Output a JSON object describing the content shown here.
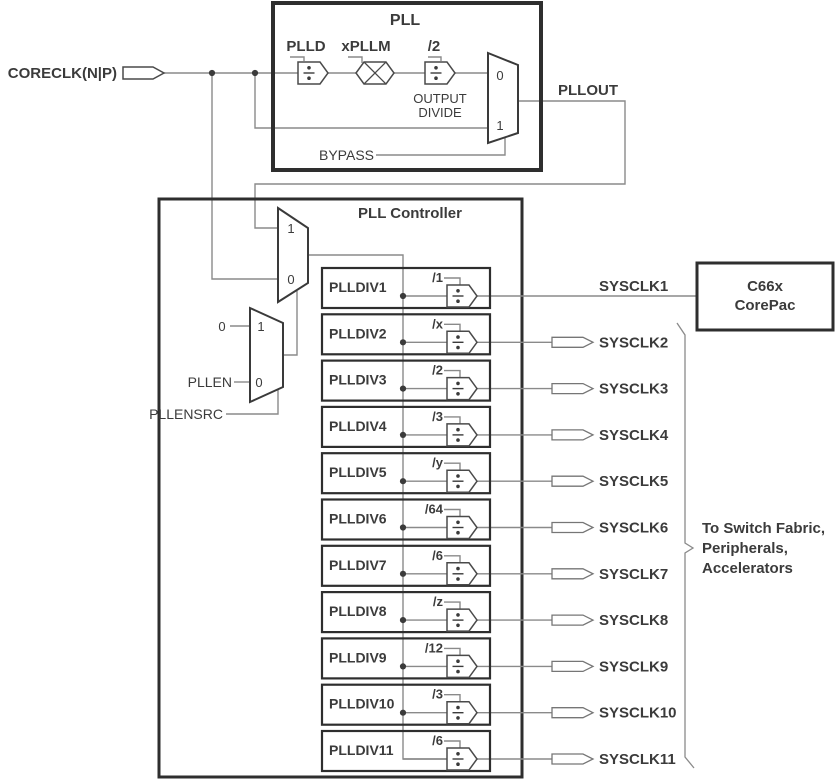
{
  "diagram": {
    "coreclk_label": "CORECLK(N|P)",
    "pll": {
      "title": "PLL",
      "plld_label": "PLLD",
      "pllm_label": "xPLLM",
      "outdiv_label": "/2",
      "outdiv_caption_line1": "OUTPUT",
      "outdiv_caption_line2": "DIVIDE",
      "mux_in0": "0",
      "mux_in1": "1",
      "bypass_label": "BYPASS",
      "pllout_label": "PLLOUT"
    },
    "controller": {
      "title": "PLL Controller",
      "clk_mux_in1": "1",
      "clk_mux_in0": "0",
      "en_mux_in1": "1",
      "en_mux_in0": "0",
      "en_const": "0",
      "pllen_label": "PLLEN",
      "pllensrc_label": "PLLENSRC"
    },
    "rows": [
      {
        "name": "PLLDIV1",
        "div": "/1",
        "out": "SYSCLK1"
      },
      {
        "name": "PLLDIV2",
        "div": "/x",
        "out": "SYSCLK2"
      },
      {
        "name": "PLLDIV3",
        "div": "/2",
        "out": "SYSCLK3"
      },
      {
        "name": "PLLDIV4",
        "div": "/3",
        "out": "SYSCLK4"
      },
      {
        "name": "PLLDIV5",
        "div": "/y",
        "out": "SYSCLK5"
      },
      {
        "name": "PLLDIV6",
        "div": "/64",
        "out": "SYSCLK6"
      },
      {
        "name": "PLLDIV7",
        "div": "/6",
        "out": "SYSCLK7"
      },
      {
        "name": "PLLDIV8",
        "div": "/z",
        "out": "SYSCLK8"
      },
      {
        "name": "PLLDIV9",
        "div": "/12",
        "out": "SYSCLK9"
      },
      {
        "name": "PLLDIV10",
        "div": "/3",
        "out": "SYSCLK10"
      },
      {
        "name": "PLLDIV11",
        "div": "/6",
        "out": "SYSCLK11"
      }
    ],
    "corepac": {
      "line1": "C66x",
      "line2": "CorePac"
    },
    "fanout_note": {
      "line1": "To Switch Fabric,",
      "line2": "Peripherals,",
      "line3": "Accelerators"
    },
    "colors": {
      "ink": "#3b3b3b",
      "box_stroke": "#2e2e2e",
      "wire": "#8a8a8a"
    }
  }
}
